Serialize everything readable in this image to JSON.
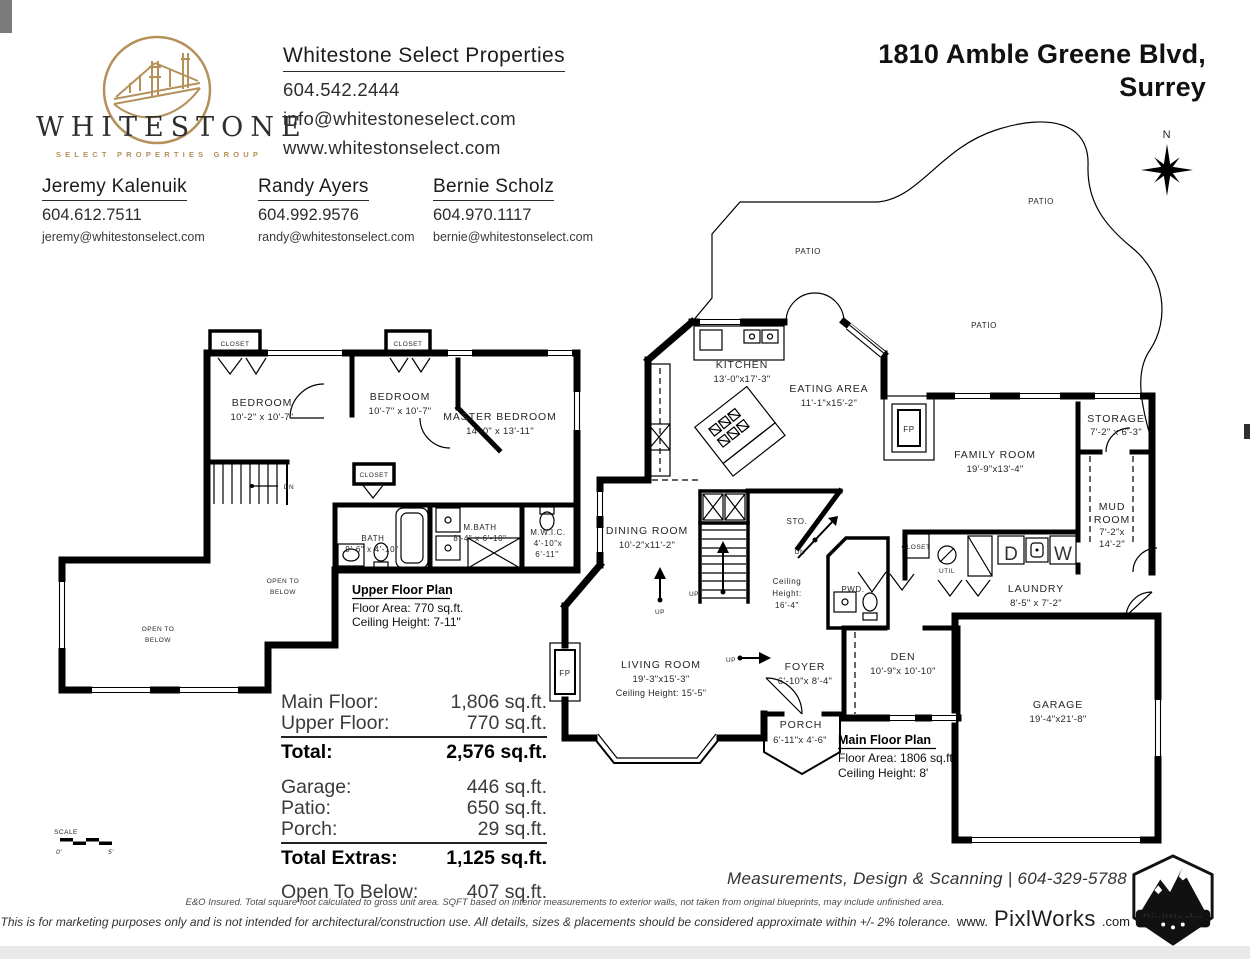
{
  "brand": {
    "wordmark": "WHITESTONE",
    "tagline": "SELECT PROPERTIES GROUP",
    "gold": "#b4905a"
  },
  "office": {
    "name": "Whitestone Select Properties",
    "phone": "604.542.2444",
    "email": "info@whitestoneselect.com",
    "website": "www.whitestonselect.com"
  },
  "agents": [
    {
      "name": "Jeremy Kalenuik",
      "phone": "604.612.7511",
      "email": "jeremy@whitestonselect.com"
    },
    {
      "name": "Randy Ayers",
      "phone": "604.992.9576",
      "email": "randy@whitestonselect.com"
    },
    {
      "name": "Bernie Scholz",
      "phone": "604.970.1117",
      "email": "bernie@whitestonselect.com"
    }
  ],
  "property": {
    "address_line1": "1810 Amble Greene Blvd,",
    "address_line2": "Surrey"
  },
  "compass": {
    "north": "N"
  },
  "plan": {
    "upper": {
      "title": "Upper Floor Plan",
      "area": "Floor Area: 770 sq.ft.",
      "ceiling": "Ceiling Height: 7-11\""
    },
    "main": {
      "title": "Main Floor Plan",
      "area": "Floor Area: 1806 sq.ft.",
      "ceiling": "Ceiling Height: 8'"
    },
    "rooms": [
      {
        "name": "BEDROOM",
        "dims": "10'-2\" x 10'-7\""
      },
      {
        "name": "BEDROOM",
        "dims": "10'-7\" x 10'-7\""
      },
      {
        "name": "MASTER BEDROOM",
        "dims": "14'-0\" x 13'-11\""
      },
      {
        "name": "BATH",
        "dims": "9'-6\" x 4'-10\""
      },
      {
        "name": "M.BATH",
        "dims": "8'-4\" x 6'-10\""
      },
      {
        "name": "M.W.I.C.",
        "dims1": "4'-10\"x",
        "dims2": "6'-11\""
      },
      {
        "name": "KITCHEN",
        "dims": "13'-0\"x17'-3\""
      },
      {
        "name": "EATING AREA",
        "dims": "11'-1\"x15'-2\""
      },
      {
        "name": "FAMILY ROOM",
        "dims": "19'-9\"x13'-4\""
      },
      {
        "name": "STORAGE",
        "dims": "7'-2\" x 6'-3\""
      },
      {
        "name1": "MUD",
        "name2": "ROOM",
        "dims1": "7'-2\"x",
        "dims2": "14'-2\""
      },
      {
        "name": "DINING ROOM",
        "dims": "10'-2\"x11'-2\""
      },
      {
        "name": "LAUNDRY",
        "dims": "8'-5\" x 7'-2\""
      },
      {
        "name": "LIVING ROOM",
        "dims": "19'-3\"x15'-3\"",
        "note": "Ceiling Height: 15'-5\""
      },
      {
        "name": "FOYER",
        "dims": "6'-10\"x 8'-4\""
      },
      {
        "name": "DEN",
        "dims": "10'-9\"x 10'-10\""
      },
      {
        "name": "PORCH",
        "dims": "6'-11\"x 4'-6\""
      },
      {
        "name": "GARAGE",
        "dims": "19'-4\"x21'-8\""
      }
    ],
    "labels": {
      "patio": "PATIO",
      "closet": "CLOSET",
      "open1": "OPEN TO",
      "open2": "BELOW",
      "sto": "STO.",
      "pwd": "PWD.",
      "util": "UTIL",
      "dryer": "D",
      "washer": "W",
      "up": "UP",
      "dn": "DN",
      "fp": "FP",
      "ceil1": "Ceiling",
      "ceil2": "Height:",
      "ceil3": "16'-4\""
    }
  },
  "scale": {
    "label": "SCALE",
    "zero": "0'",
    "five": "5'"
  },
  "areas_table": {
    "main_floor": {
      "label": "Main Floor:",
      "value": "1,806 sq.ft."
    },
    "upper_floor": {
      "label": "Upper Floor:",
      "value": "770 sq.ft."
    },
    "total": {
      "label": "Total:",
      "value": "2,576 sq.ft."
    },
    "garage": {
      "label": "Garage:",
      "value": "446 sq.ft."
    },
    "patio": {
      "label": "Patio:",
      "value": "650 sq.ft."
    },
    "porch": {
      "label": "Porch:",
      "value": "29 sq.ft."
    },
    "total_extras": {
      "label": "Total Extras:",
      "value": "1,125 sq.ft."
    },
    "open_to_below": {
      "label": "Open To Below:",
      "value": "407 sq.ft."
    }
  },
  "footer": {
    "tagline": "Measurements, Design & Scanning | 604-329-5788",
    "disclaimer1": "E&O Insured.  Total square foot calculated to gross unit area. SQFT based on interior measurements to exterior walls, not taken from original blueprints, may include unfinished area.",
    "disclaimer2": "This is for marketing purposes only and is not intended for architectural/construction use.  All details, sizes & placements should be considered approximate within +/- 2% tolerance.",
    "url_www": "www.",
    "url_brand": "PixlWorks",
    "url_com": ".com",
    "badge_text": "PixlWorks"
  }
}
